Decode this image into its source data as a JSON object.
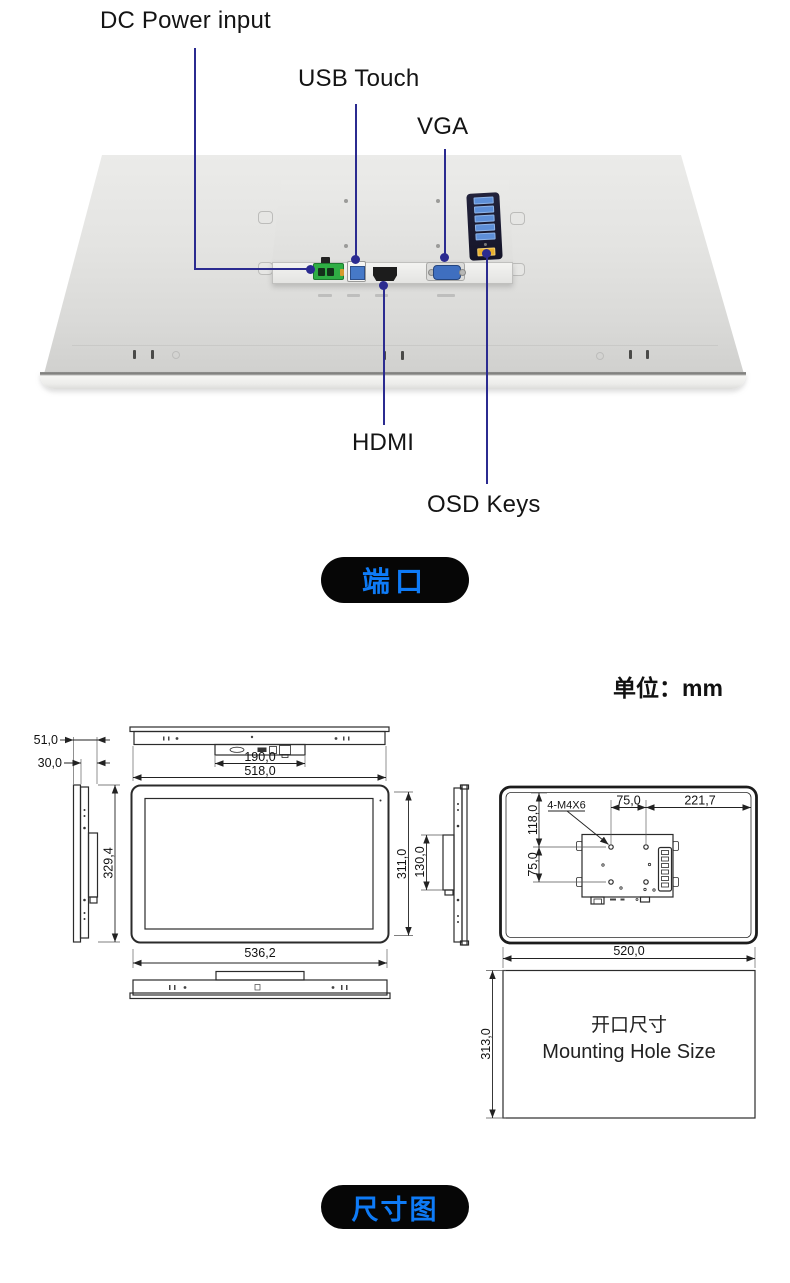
{
  "port_section": {
    "labels": {
      "dc_power": "DC Power input",
      "usb_touch": "USB Touch",
      "vga": "VGA",
      "hdmi": "HDMI",
      "osd_keys": "OSD Keys"
    },
    "badge_label": "端口"
  },
  "dimension_section": {
    "unit_label": "单位：mm",
    "badge_label": "尺寸图",
    "side_view": {
      "depth_total": "51,0",
      "depth_rear": "30,0",
      "height": "329,4"
    },
    "top_view": {
      "port_area_width": "190,0",
      "rear_width": "518,0"
    },
    "front_view": {
      "width": "536,2",
      "height": "311,0",
      "rear_box_height": "130,0"
    },
    "back_view": {
      "screw_spec": "4-M4X6",
      "top_offset": "118,0",
      "vesa_vertical": "75,0",
      "vesa_horizontal": "75,0",
      "right_offset": "221,7",
      "cutout_width": "520,0"
    },
    "mounting_hole": {
      "height": "313,0",
      "title_cn": "开口尺寸",
      "title_en": "Mounting Hole Size"
    }
  },
  "colors": {
    "accent_blue": "#0e7bf7",
    "leader_line": "#2b2b90",
    "badge_bg": "#060606"
  }
}
